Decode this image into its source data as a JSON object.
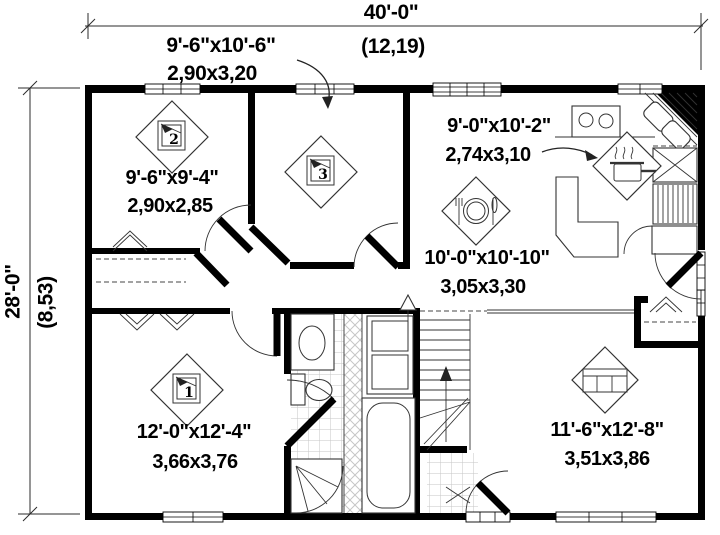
{
  "plan": {
    "overall": {
      "width_ft": "40'-0\"",
      "width_m": "(12,19)",
      "depth_ft": "28'-0\"",
      "depth_m": "(8,53)"
    },
    "rooms": {
      "bedroom3": {
        "number": "3",
        "size_ft": "9'-6\"x10'-6\"",
        "size_m": "2,90x3,20",
        "icon": "bed-icon"
      },
      "bedroom2": {
        "number": "2",
        "size_ft": "9'-6\"x9'-4\"",
        "size_m": "2,90x2,85",
        "icon": "bed-icon"
      },
      "bedroom1": {
        "number": "1",
        "size_ft": "12'-0\"x12'-4\"",
        "size_m": "3,66x3,76",
        "icon": "bed-icon"
      },
      "kitchen": {
        "size_ft": "9'-0\"x10'-2\"",
        "size_m": "2,74x3,10",
        "icon": "cooking-pot-icon"
      },
      "dining": {
        "size_ft": "10'-0\"x10'-10\"",
        "size_m": "3,05x3,30",
        "icon": "plate-cutlery-icon"
      },
      "living": {
        "size_ft": "11'-6\"x12'-8\"",
        "size_m": "3,51x3,86",
        "icon": "sofa-icon"
      }
    },
    "colors": {
      "wall": "#000000",
      "line": "#2b2b2b",
      "tile": "#c6c6c6",
      "background": "#ffffff"
    }
  }
}
